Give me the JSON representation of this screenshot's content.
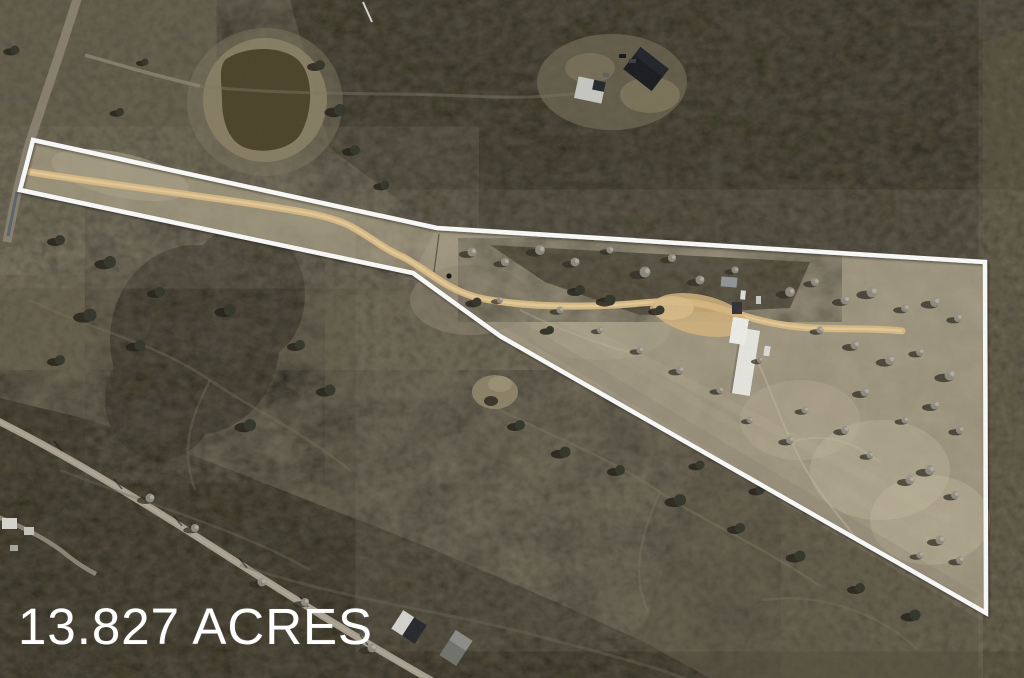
{
  "image": {
    "acreage_label": "13.827 ACRES",
    "colors": {
      "boundary_line": "#ffffff",
      "label_text": "#ffffff",
      "dirt_road": "#d9bb85",
      "paved_road": "#a8a090",
      "forest": "#38352a",
      "pasture_dark": "#5b5545",
      "cleared_parcel": "#a49b84",
      "pond_water": "#4b4229",
      "right_field": "#474230"
    },
    "features": {
      "boundary": "property-boundary",
      "pond": "pond",
      "dirt_road": "dirt-driveway",
      "county_road": "county-road",
      "homestead": "homestead-buildings",
      "neighbor_house": "neighboring-house",
      "label": "acreage-label"
    }
  }
}
